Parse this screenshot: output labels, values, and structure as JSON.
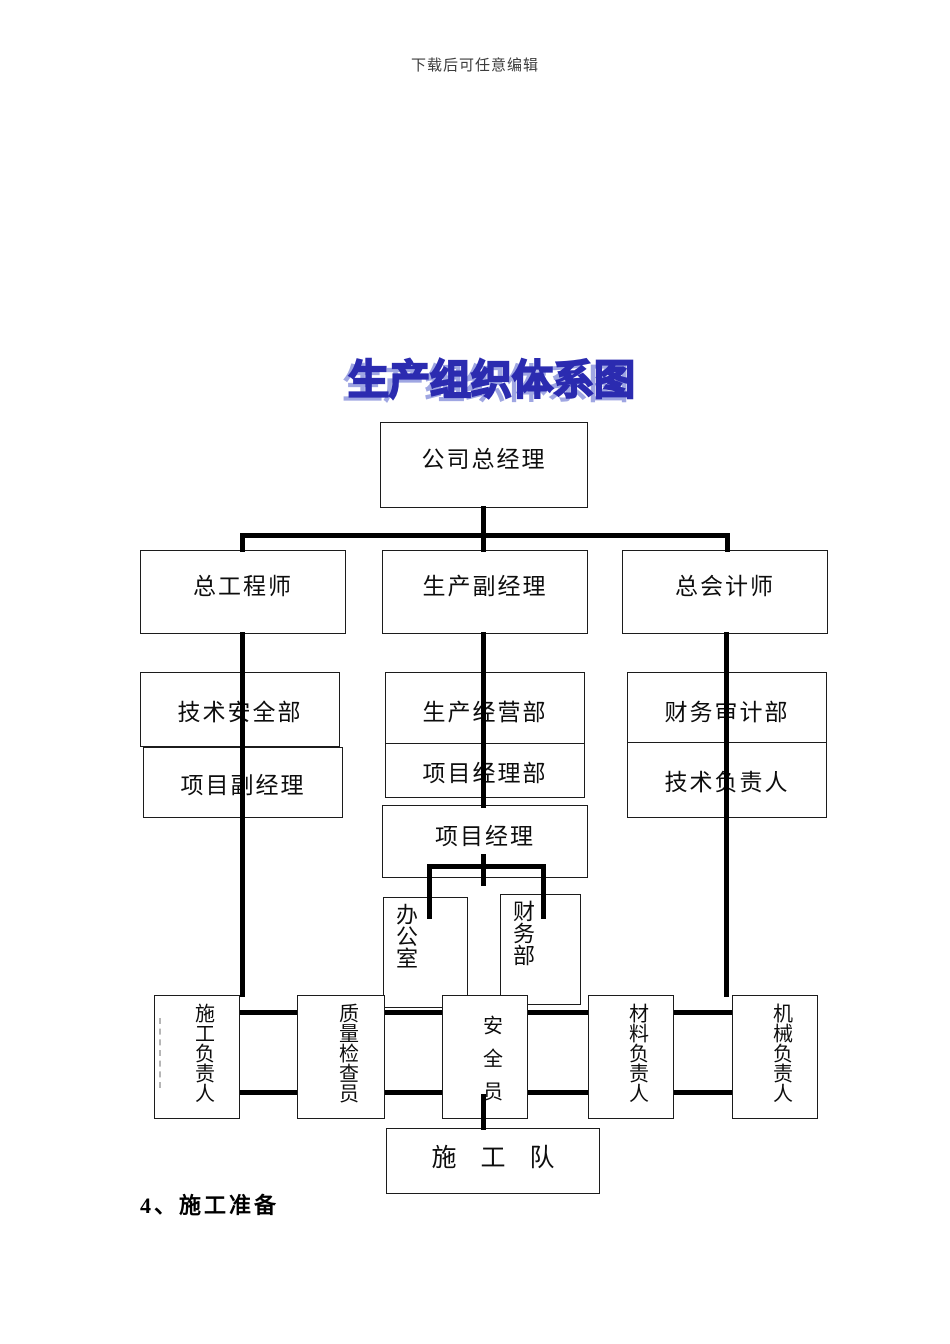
{
  "meta": {
    "watermark": "下载后可任意编辑",
    "section_heading": "4、施工准备"
  },
  "diagram": {
    "title": "生产组织体系图",
    "colors": {
      "title_fill": "#b9bde9",
      "title_outline": "#2b2bb0",
      "title_shadow": "#9fa6e2",
      "connector": "#000000",
      "box_border": "#1c1c1c",
      "box_background": "#ffffff"
    },
    "nodes": {
      "company_general_manager": {
        "label": "公司总经理"
      },
      "chief_engineer": {
        "label": "总工程师"
      },
      "production_deputy_manager": {
        "label": "生产副经理"
      },
      "chief_accountant": {
        "label": "总会计师"
      },
      "tech_safety_dept": {
        "label": "技术安全部"
      },
      "production_operations_dept": {
        "label": "生产经营部"
      },
      "finance_audit_dept": {
        "label": "财务审计部"
      },
      "project_deputy_manager": {
        "label": "项目副经理"
      },
      "project_manager_dept": {
        "label": "项目经理部"
      },
      "technical_responsible": {
        "label": "技术负责人"
      },
      "project_manager": {
        "label": "项目经理"
      },
      "office": {
        "label": "办公室"
      },
      "finance_dept": {
        "label": "财务部"
      },
      "construction_lead": {
        "label": "施工负责人"
      },
      "quality_inspector": {
        "label": "质量检查员"
      },
      "safety_officer": {
        "label": "安全员"
      },
      "materials_lead": {
        "label": "材料负责人"
      },
      "machinery_lead": {
        "label": "机械负责人"
      },
      "construction_team": {
        "label": "施工队"
      }
    }
  }
}
